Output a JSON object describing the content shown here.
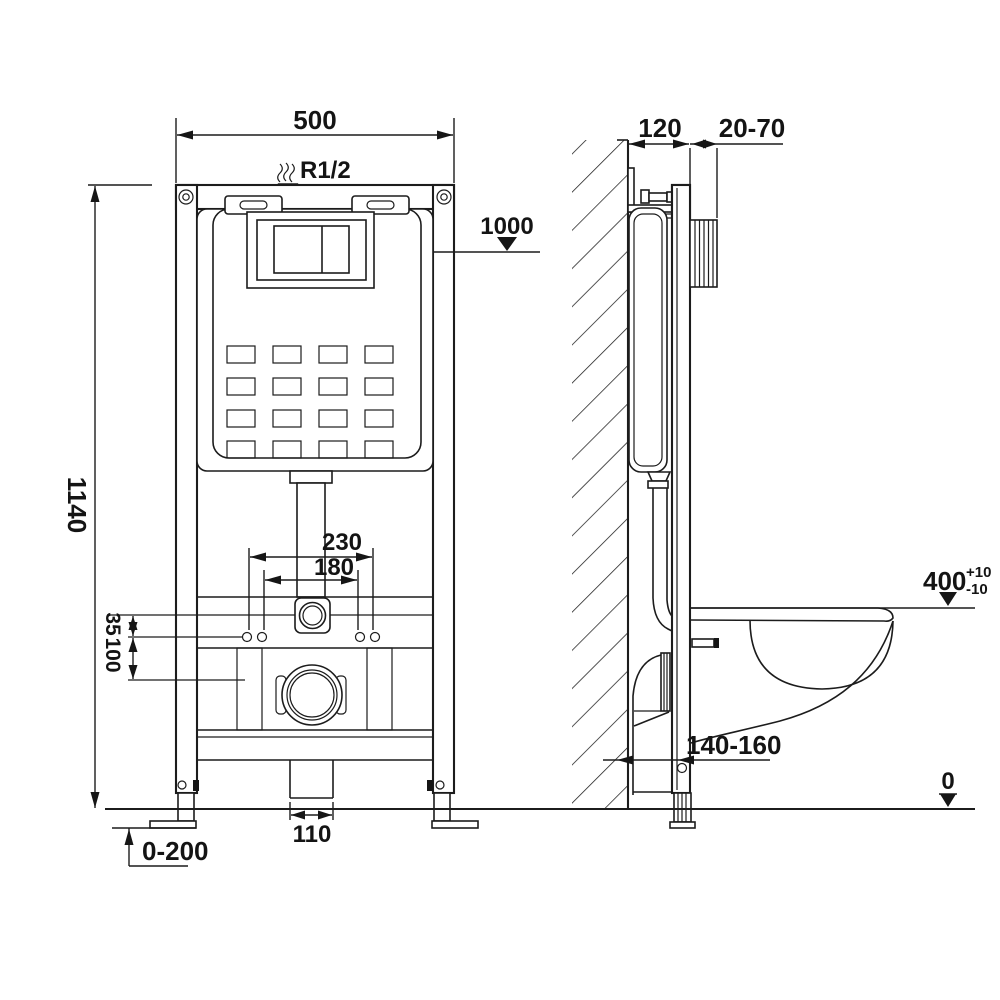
{
  "drawing": {
    "type": "technical-installation-diagram",
    "subject": "wall-hung toilet concealed cistern frame, front and side views",
    "units": "mm",
    "colors": {
      "line": "#1c1c1c",
      "background": "#ffffff"
    }
  },
  "front_view": {
    "frame_width": "500",
    "frame_height": "1140",
    "water_inlet_thread": "R1/2",
    "actuator_height": "1000",
    "bolt_spacing_outer": "230",
    "bolt_spacing_inner": "180",
    "offset_small": "35",
    "offset_large": "100",
    "drain_pipe_width": "110",
    "feet_adjust_range": "0-200"
  },
  "side_view": {
    "frame_depth": "120",
    "wall_finish_range": "20-70",
    "bowl_height": "400",
    "bowl_height_tol_plus": "+10",
    "bowl_height_tol_minus": "-10",
    "outlet_range": "140-160",
    "floor_datum": "0"
  }
}
